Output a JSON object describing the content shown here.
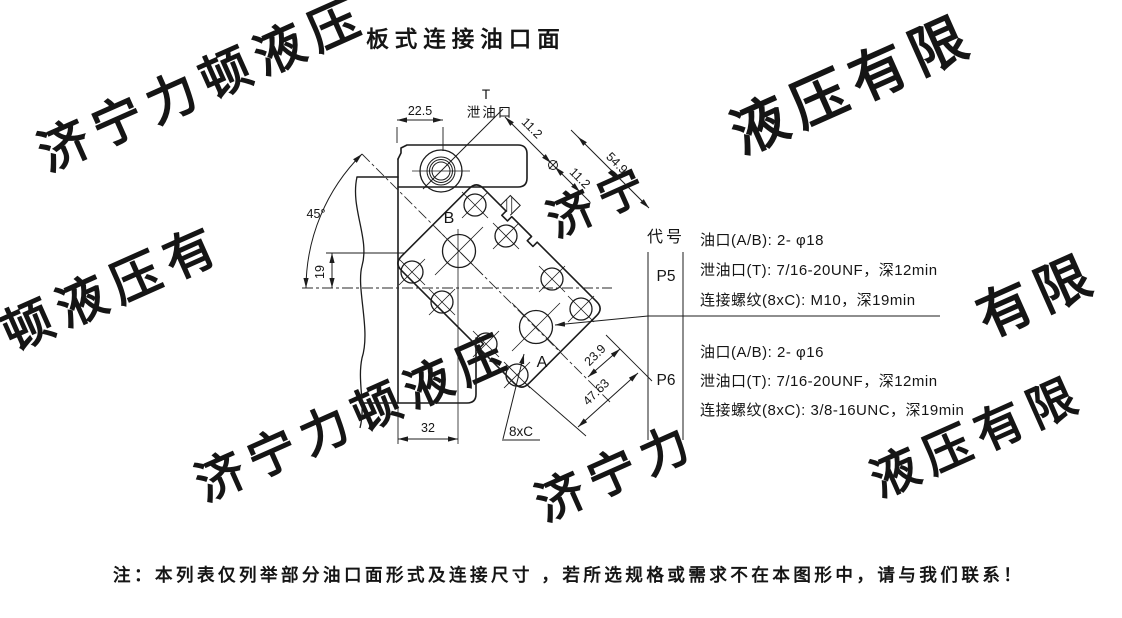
{
  "title": "板式连接油口面",
  "watermark": {
    "color": "#ebebeb",
    "runs": [
      "济宁力顿液压",
      "液压有限",
      "顿液压有",
      "济宁力顿液压",
      "济宁力",
      "液压有限",
      "有限",
      "济宁"
    ]
  },
  "drawing": {
    "port_top_label": "T",
    "port_top_name": "泄油口",
    "port_b": "B",
    "port_a": "A",
    "bolt_callout": "8xC",
    "dims": {
      "d22": "22.5",
      "d11a": "11.2",
      "d11b": "11.2",
      "d549": "54.9",
      "d45": "45°",
      "d19": "19",
      "d32": "32",
      "d239": "23.9",
      "d4763": "47.63"
    }
  },
  "table": {
    "header": "代号",
    "rows": [
      {
        "code": "P5",
        "specs": [
          "油口(A/B): 2- φ18",
          "泄油口(T): 7/16-20UNF，深12min",
          "连接螺纹(8xC): M10，深19min"
        ]
      },
      {
        "code": "P6",
        "specs": [
          "油口(A/B): 2- φ16",
          "泄油口(T): 7/16-20UNF，深12min",
          "连接螺纹(8xC): 3/8-16UNC，深19min"
        ]
      }
    ]
  },
  "note": "注：本列表仅列举部分油口面形式及连接尺寸 ，若所选规格或需求不在本图形中，请与我们联系！"
}
